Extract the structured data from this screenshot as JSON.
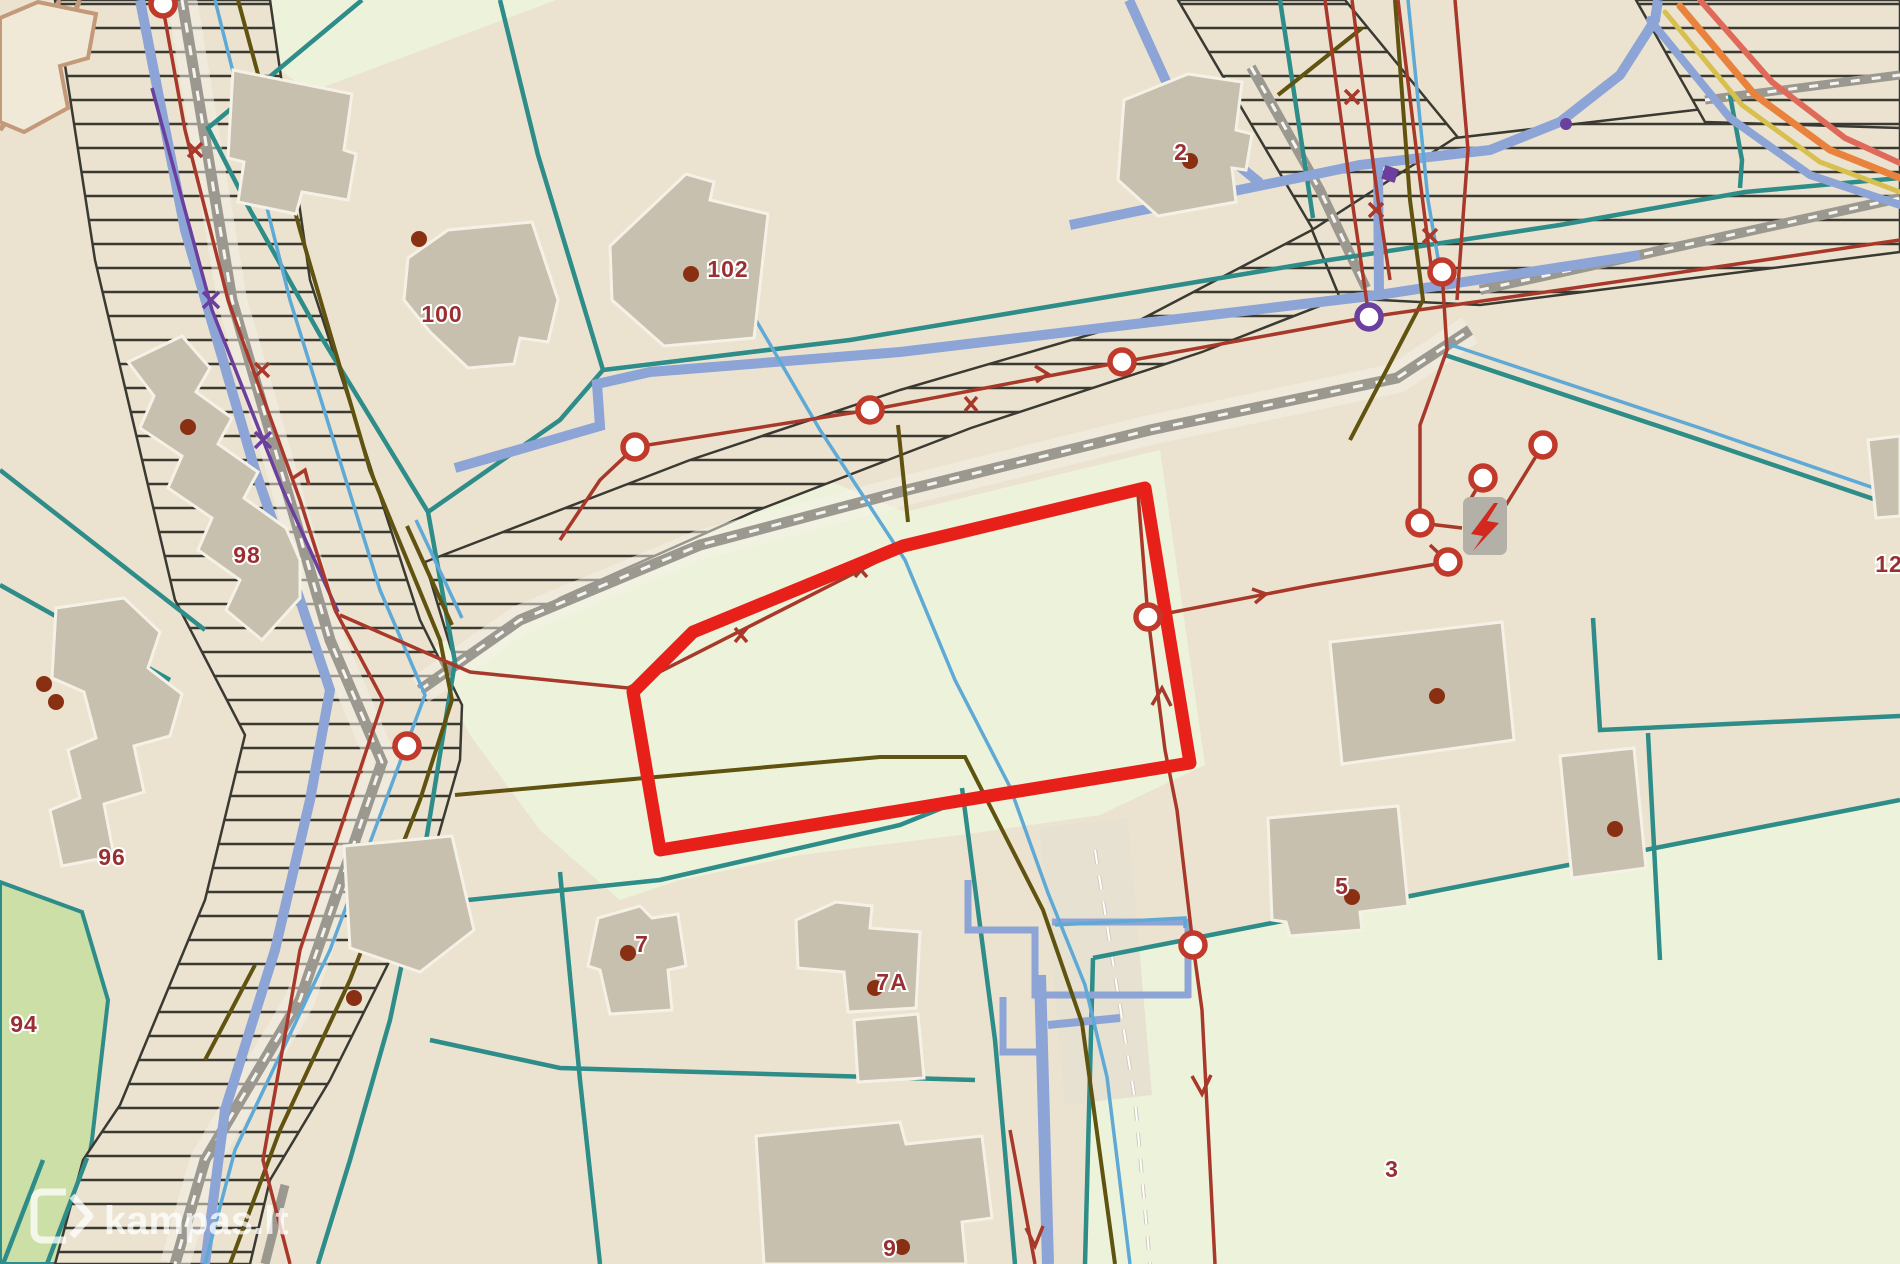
{
  "map": {
    "watermark": {
      "logo": "kampas-logo",
      "text": "kampas.lt"
    },
    "colors": {
      "bg": "#ebe3d0",
      "palegreen": "#edf3da",
      "brightgreen": "#cbdfa6",
      "building": "#c7c0ae",
      "buildinghalo": "#f5f1e6",
      "tan": "#c3997a",
      "tanfill": "#f1e9d8",
      "teal": "#2e8c89",
      "blue": "#8ca4d6",
      "lightblue": "#5ea9d6",
      "olive": "#60520f",
      "brick": "#a8382a",
      "nodering": "#c0392b",
      "selected": "#e8201a",
      "purple": "#6a3f9e",
      "roadgray": "#9b9890",
      "hatch": "#3a3a32",
      "label": "#9a2f31",
      "dot": "#8a3012",
      "pathdash": "#cfcabc",
      "boundary_orange": "#e8823c",
      "boundary_salmon": "#e06a5a",
      "boundary_yellow": "#d8c050"
    },
    "parcel_labels": [
      {
        "text": "100",
        "x": 442,
        "y": 322
      },
      {
        "text": "102",
        "x": 728,
        "y": 277
      },
      {
        "text": "2",
        "x": 1181,
        "y": 160
      },
      {
        "text": "98",
        "x": 247,
        "y": 563
      },
      {
        "text": "96",
        "x": 112,
        "y": 865
      },
      {
        "text": "94",
        "x": 24,
        "y": 1032
      },
      {
        "text": "7",
        "x": 642,
        "y": 952
      },
      {
        "text": "7A",
        "x": 892,
        "y": 990
      },
      {
        "text": "9",
        "x": 890,
        "y": 1256
      },
      {
        "text": "5",
        "x": 1342,
        "y": 894
      },
      {
        "text": "3",
        "x": 1392,
        "y": 1177
      },
      {
        "text": "12",
        "x": 1889,
        "y": 572
      }
    ],
    "building_dots": [
      {
        "x": 419,
        "y": 239
      },
      {
        "x": 691,
        "y": 274
      },
      {
        "x": 1190,
        "y": 161
      },
      {
        "x": 188,
        "y": 427
      },
      {
        "x": 44,
        "y": 684
      },
      {
        "x": 56,
        "y": 702
      },
      {
        "x": 628,
        "y": 953
      },
      {
        "x": 875,
        "y": 988
      },
      {
        "x": 902,
        "y": 1247
      },
      {
        "x": 354,
        "y": 998
      },
      {
        "x": 1437,
        "y": 696
      },
      {
        "x": 1352,
        "y": 897
      },
      {
        "x": 1615,
        "y": 829
      }
    ],
    "utility_nodes": [
      {
        "x": 635,
        "y": 447,
        "kind": "red"
      },
      {
        "x": 407,
        "y": 746,
        "kind": "red"
      },
      {
        "x": 870,
        "y": 410,
        "kind": "red"
      },
      {
        "x": 1122,
        "y": 362,
        "kind": "red"
      },
      {
        "x": 1369,
        "y": 317,
        "kind": "purple"
      },
      {
        "x": 1442,
        "y": 272,
        "kind": "red"
      },
      {
        "x": 1483,
        "y": 478,
        "kind": "red"
      },
      {
        "x": 1420,
        "y": 523,
        "kind": "red"
      },
      {
        "x": 1448,
        "y": 562,
        "kind": "red"
      },
      {
        "x": 1543,
        "y": 445,
        "kind": "red"
      },
      {
        "x": 1148,
        "y": 617,
        "kind": "red"
      },
      {
        "x": 1193,
        "y": 945,
        "kind": "red"
      },
      {
        "x": 163,
        "y": 4,
        "kind": "red"
      }
    ],
    "icons": {
      "power_substation": {
        "name": "lightning-bolt-icon",
        "x": 1463,
        "y": 497
      }
    }
  }
}
